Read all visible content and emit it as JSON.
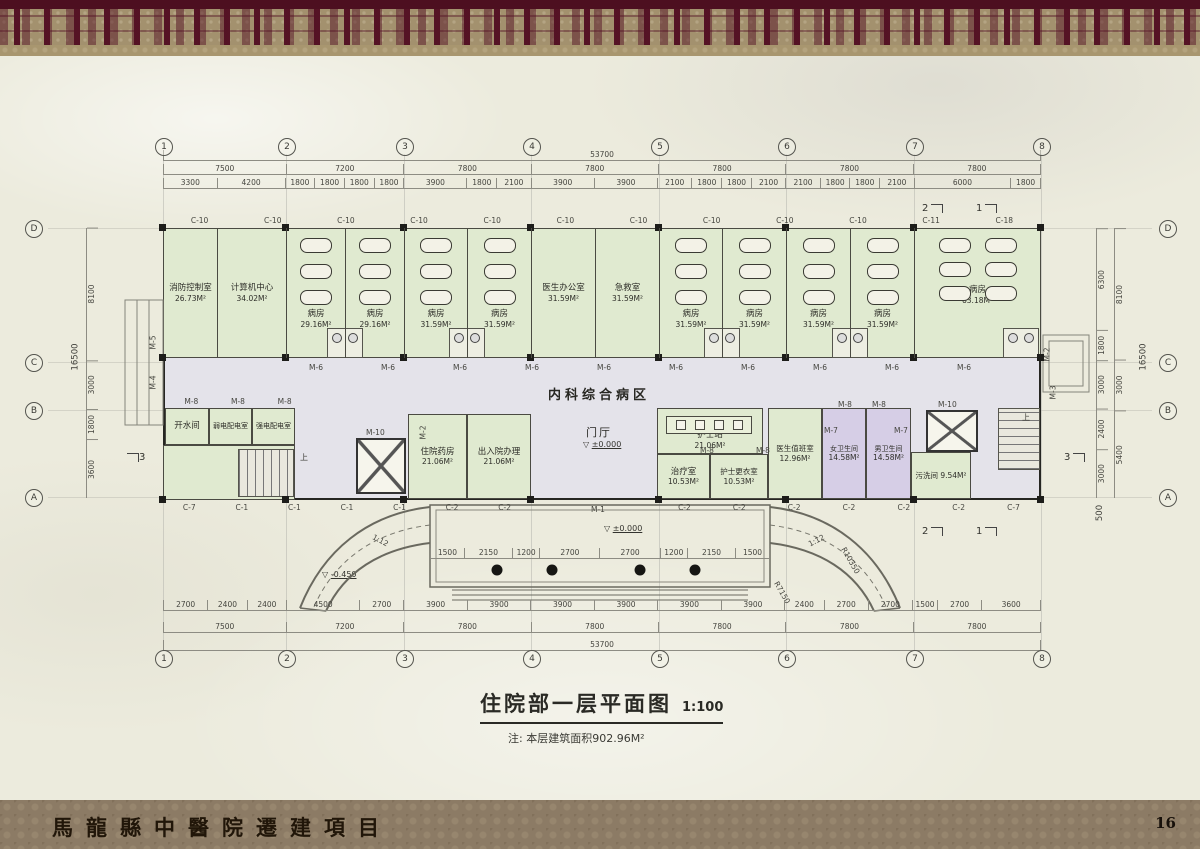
{
  "banner": {
    "project_title": "馬龍縣中醫院遷建項目",
    "page_number": "16"
  },
  "title_block": {
    "title": "住院部一层平面图",
    "scale": "1:100",
    "note": "注: 本层建筑面积902.96M²"
  },
  "corridor_label": "内科综合病区",
  "lobby_label": "门厅",
  "stair_up": "上",
  "grid": {
    "columns": [
      "1",
      "2",
      "3",
      "4",
      "5",
      "6",
      "7",
      "8"
    ],
    "rows": [
      "D",
      "C",
      "B",
      "A"
    ]
  },
  "rooms": {
    "top": [
      {
        "name": "消防控制室",
        "area": "26.73M²"
      },
      {
        "name": "计算机中心",
        "area": "34.02M²"
      },
      {
        "name": "病房",
        "area": "29.16M²"
      },
      {
        "name": "病房",
        "area": "29.16M²"
      },
      {
        "name": "病房",
        "area": "31.59M²"
      },
      {
        "name": "病房",
        "area": "31.59M²"
      },
      {
        "name": "医生办公室",
        "area": "31.59M²"
      },
      {
        "name": "急救室",
        "area": "31.59M²"
      },
      {
        "name": "病房",
        "area": "31.59M²"
      },
      {
        "name": "病房",
        "area": "31.59M²"
      },
      {
        "name": "病房",
        "area": "31.59M²"
      },
      {
        "name": "病房",
        "area": "31.59M²"
      },
      {
        "name": "病房",
        "area": "63.18M²"
      }
    ],
    "bottom": [
      {
        "name": "开水间",
        "area": ""
      },
      {
        "name": "弱电配电室",
        "area": ""
      },
      {
        "name": "强电配电室",
        "area": ""
      },
      {
        "name": "住院药房",
        "area": "21.06M²"
      },
      {
        "name": "出入院办理",
        "area": "21.06M²"
      },
      {
        "name": "护士站",
        "area": "21.06M²"
      },
      {
        "name": "治疗室",
        "area": "10.53M²"
      },
      {
        "name": "护士更衣室",
        "area": "10.53M²"
      },
      {
        "name": "医生值班室",
        "area": "12.96M²"
      },
      {
        "name": "女卫生间",
        "area": "14.58M²"
      },
      {
        "name": "男卫生间",
        "area": "14.58M²"
      },
      {
        "name": "污洗间",
        "area": "9.54M²"
      }
    ]
  },
  "dimensions": {
    "top_total": "53700",
    "top_bays": [
      7500,
      7200,
      7800,
      7800,
      7800,
      7800,
      7800
    ],
    "top_segments": [
      3300,
      4200,
      1800,
      1800,
      1800,
      1800,
      3900,
      1800,
      2100,
      3900,
      3900,
      2100,
      1800,
      1800,
      2100,
      2100,
      1800,
      1800,
      2100,
      6000,
      1800
    ],
    "bottom_segments": [
      2700,
      2400,
      2400,
      4500,
      2700,
      3900,
      3900,
      3900,
      3900,
      3900,
      3900,
      2400,
      2700,
      2700,
      1500,
      2700,
      3600
    ],
    "bottom_bays": [
      7500,
      7200,
      7800,
      7800,
      7800,
      7800,
      7800
    ],
    "bottom_total": "53700",
    "entrance_segments": [
      1500,
      2150,
      1200,
      2700,
      2700,
      1200,
      2150,
      1500
    ],
    "left_segments": [
      8100,
      3000,
      1800,
      3600
    ],
    "left_total": "16500",
    "right_inner": [
      6300,
      1800,
      3000,
      2400,
      3000
    ],
    "right_mid": [
      8100,
      3000,
      5400
    ],
    "right_total": "16500",
    "right_below": "500"
  },
  "levels": {
    "lobby": "±0.000",
    "entrance": "±0.000",
    "ramp": "-0.450"
  },
  "ramps": {
    "slope": "1:12",
    "radius_outer": "R10350",
    "radius_inner": "R7150"
  },
  "sections": {
    "s1": "1",
    "s2": "2",
    "s3": "3"
  },
  "labels": {
    "top_windows": [
      "C-10",
      "C-10",
      "C-10",
      "C-10",
      "C-10",
      "C-10",
      "C-10",
      "C-10",
      "C-10",
      "C-10",
      "C-11",
      "C-18"
    ],
    "corridor_doors": [
      "M-6",
      "M-6",
      "M-6",
      "M-6",
      "M-6",
      "M-6",
      "M-6",
      "M-6",
      "M-6",
      "M-6"
    ],
    "annex_doors": [
      "M-8",
      "M-8",
      "M-8"
    ],
    "bottom_left_windows": [
      "C-7",
      "C-1",
      "C-1",
      "C-1",
      "C-1",
      "C-2",
      "C-2"
    ],
    "bottom_right_windows": [
      "C-2",
      "C-2",
      "C-2",
      "C-2",
      "C-2",
      "C-2",
      "C-7"
    ],
    "m1": "M-1",
    "m2": "M-2",
    "m3": "M-3",
    "m4": "M-4",
    "m5": "M-5",
    "m7": "M-7",
    "m8": "M-8",
    "m10": "M-10"
  }
}
